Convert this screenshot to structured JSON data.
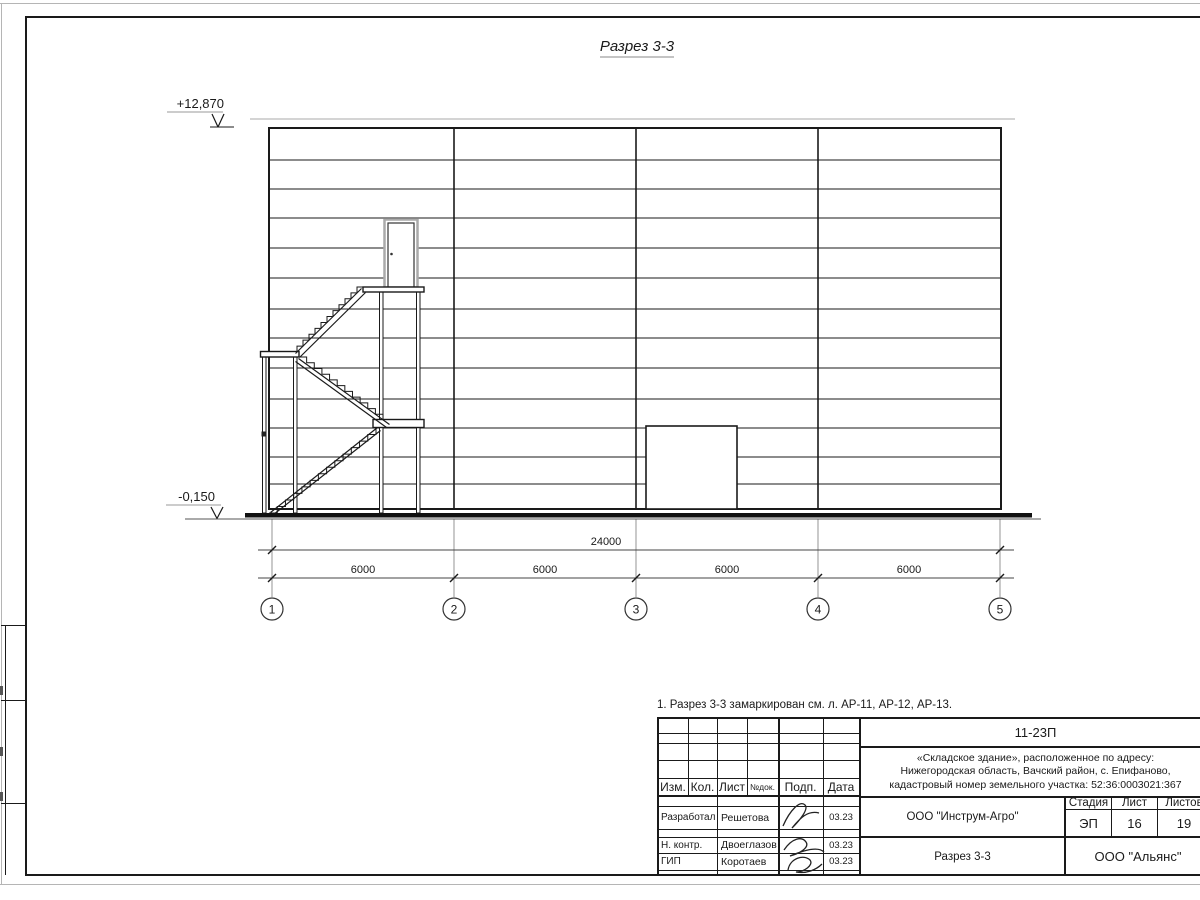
{
  "page": {
    "note": "1. Разрез 3-3 замаркирован см. л. АР-11, АР-12, АР-13."
  },
  "drawing": {
    "title": "Разрез 3-3",
    "level_top": "+12,870",
    "level_bottom": "-0,150",
    "dim_total": "24000",
    "dim_segments": [
      "6000",
      "6000",
      "6000",
      "6000"
    ],
    "axes": [
      "1",
      "2",
      "3",
      "4",
      "5"
    ]
  },
  "title_block": {
    "doc_number": "11-23П",
    "object_address_lines": [
      "«Складское здание», расположенное по адресу:",
      "Нижегородская область, Вачский район, с. Епифаново,",
      "кадастровый номер земельного участка: 52:36:0003021:367"
    ],
    "columns": {
      "izm": "Изм.",
      "kol": "Кол.",
      "list": "Лист",
      "ndok": "№док.",
      "podp": "Подп.",
      "data": "Дата"
    },
    "rows": [
      {
        "role": "Разработал",
        "name": "Решетова",
        "date": "03.23"
      },
      {
        "role": "Н. контр.",
        "name": "Двоеглазов",
        "date": "03.23"
      },
      {
        "role": "ГИП",
        "name": "Коротаев",
        "date": "03.23"
      }
    ],
    "developer": "ООО \"Инструм-Агро\"",
    "stage_label": "Стадия",
    "sheet_label": "Лист",
    "sheets_label": "Листов",
    "stage": "ЭП",
    "sheet": "16",
    "sheets": "19",
    "sheet_title": "Разрез 3-3",
    "company": "ООО \"Альянс\""
  },
  "colors": {
    "line": "#1a1a1a",
    "light_line": "#b5b5b5"
  }
}
